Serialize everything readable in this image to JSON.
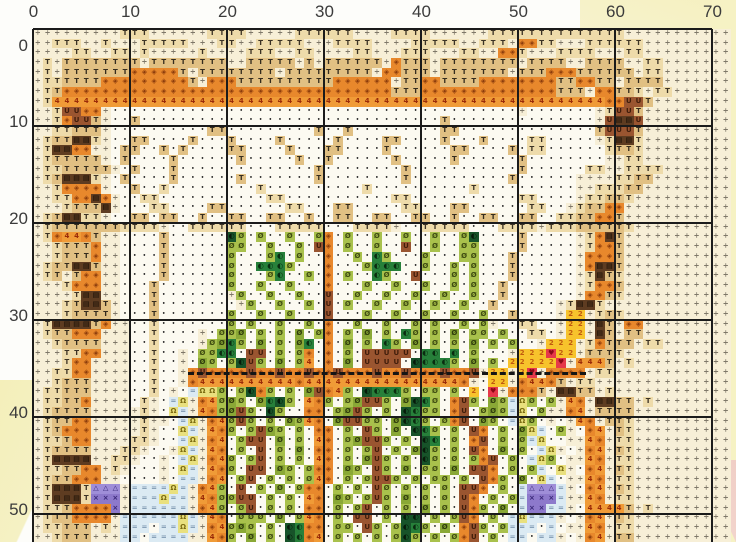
{
  "pattern": {
    "kind": "cross-stitch color chart (scanned page)",
    "axes": {
      "top_labels": [
        "0",
        "10",
        "20",
        "30",
        "40",
        "50",
        "60",
        "70"
      ],
      "left_labels": [
        "0",
        "10",
        "20",
        "30",
        "40",
        "50"
      ],
      "major_every_cells": 10
    },
    "grid": {
      "cols": 72,
      "rows": 53,
      "cell_px": 9.7,
      "origin_x": 33,
      "origin_y": 29
    },
    "palette": {
      ",": {
        "name": "cream-divide",
        "bg": "#f7efd7",
        "fg": "#6e675a",
        "glyph": "÷",
        "fs": 7
      },
      ".": {
        "name": "white-dot",
        "bg": "#fcfaf1",
        "fg": "#1c1c1c",
        "glyph": "•",
        "fs": 5
      },
      "t": {
        "name": "light-tan-T",
        "bg": "#eedbaa",
        "fg": "#3c3325",
        "glyph": "T",
        "fs": 7
      },
      "T": {
        "name": "tan-T",
        "bg": "#e1c083",
        "fg": "#352c1e",
        "glyph": "T",
        "fs": 7
      },
      "d": {
        "name": "dark-tan-T",
        "bg": "#c49e5e",
        "fg": "#2e2517",
        "glyph": "T",
        "fs": 7
      },
      "B": {
        "name": "dark-brown-window",
        "bg": "#5e3c21",
        "fg": "#120b04",
        "glyph": "▤",
        "fs": 7
      },
      "b": {
        "name": "brown-U",
        "bg": "#9a5530",
        "fg": "#401d0b",
        "glyph": "U",
        "fs": 7
      },
      "o": {
        "name": "orange-diamond",
        "bg": "#e8882c",
        "fg": "#8c3c0c",
        "glyph": "◈",
        "fs": 7
      },
      "O": {
        "name": "light-orange-diamond",
        "bg": "#f3a94c",
        "fg": "#9c4a10",
        "glyph": "◈",
        "fs": 7
      },
      "4": {
        "name": "orange-four",
        "bg": "#f09b37",
        "fg": "#9a2a08",
        "glyph": "4",
        "fs": 7
      },
      "g": {
        "name": "light-green-slashO",
        "bg": "#a9c14c",
        "fg": "#3f4c11",
        "glyph": "Ø",
        "fs": 7
      },
      "e": {
        "name": "mid-green-slashO",
        "bg": "#8aa836",
        "fg": "#2f3c0c",
        "glyph": "Ø",
        "fs": 7
      },
      "G": {
        "name": "dark-green-circle",
        "bg": "#27803a",
        "fg": "#0a2c10",
        "glyph": "◐",
        "fs": 7
      },
      "k": {
        "name": "deep-green-circle",
        "bg": "#175329",
        "fg": "#061b0a",
        "glyph": "◐",
        "fs": 7
      },
      "u": {
        "name": "pale-blue-equals",
        "bg": "#dbeaf3",
        "fg": "#7e98b0",
        "glyph": "=",
        "fs": 7
      },
      "y": {
        "name": "pale-yellow-omega",
        "bg": "#e9e07e",
        "fg": "#7c6c12",
        "glyph": "Ω",
        "fs": 7
      },
      "2": {
        "name": "yellow-two",
        "bg": "#f7c32c",
        "fg": "#c05a10",
        "glyph": "2",
        "fs": 7
      },
      "h": {
        "name": "red-heart",
        "bg": "#e6384a",
        "fg": "#8c0a16",
        "glyph": "♥",
        "fs": 7
      },
      "p": {
        "name": "purple-cross",
        "bg": "#8d79cb",
        "fg": "#3a2878",
        "glyph": "×",
        "fs": 7
      },
      "P": {
        "name": "purple-triangle",
        "bg": "#9f8ed8",
        "fg": "#3a2878",
        "glyph": "△",
        "fs": 7
      }
    },
    "rows_data": [
      ",,,,,,,,,ttt,,,,,,tttt,,,,,tttttt,,,,tttt,,,,,,tttttttttttttt,,,,,,,,,,",
      ",,ttt,,t,,,ttttt,,,tt,,ttttt,,,tttt,,,,ttttt,,ttt,oott,,,tttttt,,,,,,,",
      ",,,,tt,,tt,t,,,,,t,,,,ttt,,tt,,,,tt,,,ttt,,,tt,,oot,,,tttt,,,tt,,,,,,,",
      ",t,TTTTTTTT,TTTTTTTT,,TTTTT,T,TTTTTT,oTTT,TTTTTTTT,TTTT,,TTTT,,tt,,,,,",
      ",t,TTTTTTToooooT,TTTTTTTT,TTTTTTTTT,ooTTT,TTTTTTT,TTToooTTTTTT,tt,,,,,",
      ",ttTTTToooooooooT,oooTTTTTTTTTToooooo,TTooTTTTooooooooTTooTT,TTTT,,,,,",
      ",tTooooooooooooooooooooooooooooooooooTTTooooooooooooooTTT,ooTTt,tt,,,,",
      ",t444444444444444444444444444444444444444444444444444444444oobbT,,,,,,",
      ",,tbboo,..........................................,.......,tbbT,,,,,,,",
      ",,tobbT,..T...............................T...............,bBBb,,,,,,,",
      ",,ttTTT,..........TT.........T..T.........TT..............TbbbT,,,,,,,",
      ",tTTBBt,..TT....T...T....T.....T....TT....T...T....tt.....,tBBt,,,,,,,",
      ",tBBoo,,.TT..T.T....TT....T...TT....T......TT....T.tt......tTTt,,,,,,,",
      ",tTTTTT,.T....T......T.....T..T......T.....T......T........,,tt,,,,,,,",
      ",ttTTTTT,.T...T..............T........T...........T......tt,,tttt,,,,,",
      ",tTBBBt,.T....T......T.......T........T..........T......,,,,ttTT,,,,,,",
      ",,toooo,..T..t.........t..........t..........t..........,,tttTT,,,,,,,",
      ",,ttooBo,..tt...........tt...........tt...........tt....,ttTTt,,,,,,,,",
      ",,,tTTTB,...tt....TT......tt...TT.....tt...TT......tt..,tTToo,,,,,,,,,",
      ",tTBBtt,..TT.TT..T..TT..TT..T..TT..TT..TT..T..TT..TT..ttTTooT,,,,,,,,,",
      ",tTTTTTTTtttt,..tttttt...ttttt...tttt,..ttttt...tttt,tttTTTTTt,,,,,,,,",
      ",to44oT,,....T......kg.g..g..go.g..g..g..g..gk....T.....,toBT,,,,,,,,,",
      ",,tTTTo,,....T......gg..g..g.bo.g..g..b..g..gg....T.....,tooT,,,,,,,,,",
      ",,tTTTo,,....T......g...gG.g..o..g.Gg...g...gg...T......,oooT,,,,,,,,,",
      ",tTTBBT,,....T......g..GGGg...o...gGGG..g..g.g...T......,oBBT,,,,,,,,,",
      ",tT,Too,,....T......g...gG..g.o.g..Gg..b...g.g...T......,tBTt,,,,,,,,,",
      ",,,tooo,,...T.......g..g..g...o...g..g..g..g.g..T.......,tooT,,,,,,,,,",
      ",,,,tBB,,...T.......,g..g..g..b..g..g..g..g..g..T.......,ooTt,,,,,,,,,",
      ",,,tTBBT,...T........,g..g..g.b.g..g..g..g..g..T......,tBBt,,,,,,,,,,,",
      ",,,tTTTT,...T.......g..g..g...b...g..g..g..g..g..T....,22,tTt,,,,,,,,,",
      ",tBBBBTo,,..t.......g.g..g..g.o..g..g..g.g..g.g,..tt..,22,BT,oo,,,,,,,",
      ",tTTooo,,,..t....,.gge.g.g.e.go.g.e.g.Gg.g.e.gg.g..tt.,22,BT,TT,,,,,,,",
      ",,tTTTT,,,..t....,geGg.e.g.eG.o.e.g.Gg.e.g.g.e.g.g..,222,toTTT,tt,,,,,",
      ",,,ttoo,,,..t..,.ggGG.bb.g.go.o.g.bbbbb.GG.G.g...,222h22,TTTt,,,,,,,,,",
      ",,,too,,,,..t..,.eg.gkbg.e.g4.o.e.bbbb.kGGGg.e.g.22222h,444T,t,,,,,,,,",
      ",,ttoo,,,,..t..,obooooboobooboobooobooboooboob,22,2h,oooo,tt,,,,,,,,,,",
      ",,tTTT,,,,..t..,o4444444444o4444444444444444o,.22,o44oT,tt,,,,,,,,,,,,",
      ",ttTTT,,,,..t.,.uyyg.gkog.g.ebo4g.kGGGg.gg.g.2.h,oooT,BBTT,t,,,,,,,,,,",
      ",ttTTo,,,,.t,.uy,o4geg.eGkg.4og.gebbg.ekGg.obg.eguyg.g,4o,BBTT,t,,,,,,",
      ",tTTTT,,,,,t,.yu,4ogebg.kg..oo.gebg.g.kGgg.ob.geguy.g,,o4,TTTT,,,,,,,,",
      ",tTToo,,,,,t,,.uy,o4gbg.g.eg4o.ebbgg.ekGg.gob.eg.uyg.,.,4o,TTt,,,,,,,,",
      ",tTooo,,,,,t,..yu,4og.gbeg.g.oo.g.bg.e.kGg.g.bo.g.eyu.g,.o4,Tt,,,,,,,,",
      ",ttToo,,,,tt,..uy,o4.gbb.e.g.4o.gebbg.g.kG.g.ob.g.guy..,,4o,tt,,,,,,,,",
      ",tTTTT,,,tt,..,yu,4o.g.b.g.e.oo.g.gb.g.ekg.g.bo.e.g.uy,.,o4,Tt,,,,,,,,",
      ",tBBBB,,tt,..,.uy,o4g.gb.g.g.4o.g.ebg.g.kg.g.gob.g.uyg.,,4o,tt,,,,,,,,",
      ",ttTToo,t,...,.yu,4og.bb.eg.goo.eg.bg.e.gg.e.bbo.g.gu.y,.o4,Tt,,,,,,,,",
      ",tTTooo,,....,.uu,o4.gb.g.g.g4o.g.gbbg.g.gg.g.bog.e.yu.,,4o,tt,,,,,,,,",
      ",tBBBtPPP,uuuuyu,o4g.b.g.e.goo.g.g.bg.g.g.g.bbo.g.uPPPu,.o4,Tt,,,,,,,,",
      ",tBBBtppp,uuuyuu,4oggbb.g.g.4o.eg.gbg.e.g.g.bo.g.gupppu,,4o,tt,,,,,,,,",
      ",ttToooop,uuuuuu,o4g.gb.g.g.oo.g.gb.g.g.e.g.bog.e.uppuu,.4444T,t,,,,,,",
      ",tTToooo,uuuuuuyu,4o.ggg.e.g4o.g.bb.g.kk.g.gbo.g.uyuuu,.,o4,Tt,,,,,,,,",
      ",ttTTT,t,uuu.uuyu,o4geg.g.kGoo.gg.bg.gkGg.e.obg.guuu.u.,,4o,tt,,,,,,,,",
      ",,tTTT,,,uu.uuuu,,4og.e.g.kGo4.g.g.g.gkg.g.gob.g.uu.uu,.,o4,TT,,,,,,,,"
    ],
    "backstitch_dash": {
      "row": 35,
      "col_start": 16,
      "col_end": 57,
      "color": "#151515"
    },
    "page_colors": {
      "paper_white": "#fdfdfa",
      "chart_cream": "#f8f0d8",
      "margin_yellow": "#f6f2c4",
      "corner_pink": "#f0cec6",
      "major_grid_line": "#1b1b1b",
      "axis_label_color": "#3b3b3b"
    }
  }
}
